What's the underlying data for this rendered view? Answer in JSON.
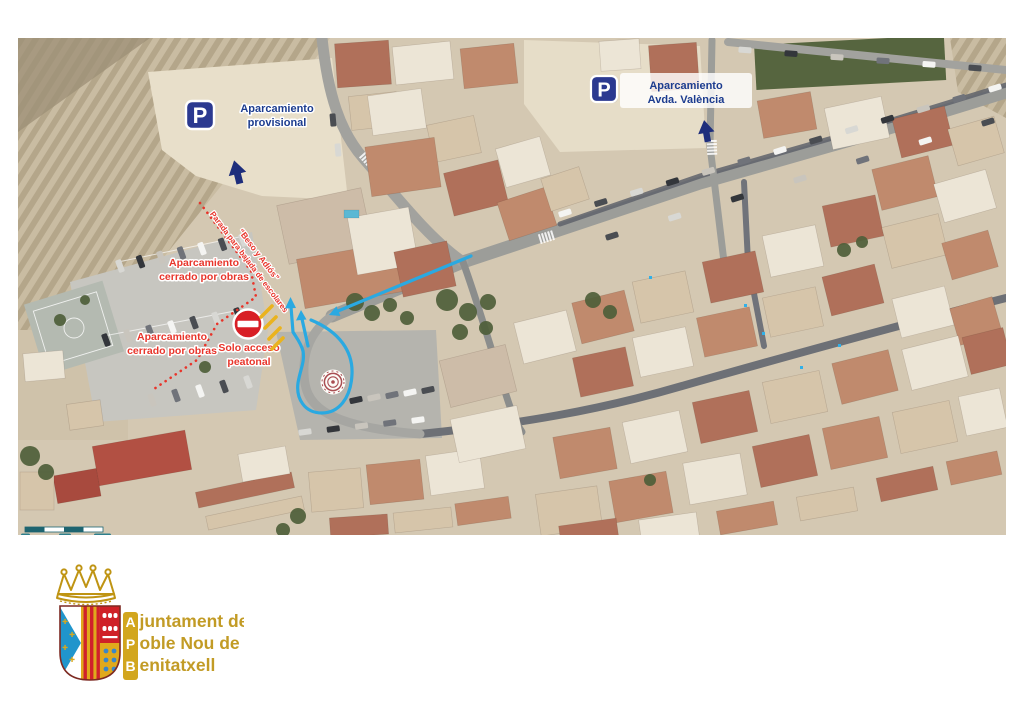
{
  "annotations": {
    "parking_provisional": {
      "icon_letter": "P",
      "line1": "Aparcamiento",
      "line2": "provisional"
    },
    "parking_avda_valencia": {
      "icon_letter": "P",
      "line1": "Aparcamiento",
      "line2": "Avda. València"
    },
    "closed_parking_upper": {
      "line1": "Aparcamiento",
      "line2": "cerrado por obras"
    },
    "closed_parking_lower": {
      "line1": "Aparcamiento",
      "line2": "cerrado por obras"
    },
    "pedestrian_only": {
      "line1": "Solo acceso",
      "line2": "peatonal"
    },
    "kiss_and_ride": {
      "line1": "“Beso y Adiós”",
      "line2": "Parada para bajada de escolares"
    }
  },
  "scale_bar": {
    "label_0": "0",
    "label_mid": "10",
    "label_end": "20m"
  },
  "logo": {
    "initials": [
      "A",
      "P",
      "B"
    ],
    "line1_rest": "juntament del",
    "line2_rest": "oble Nou de",
    "line3_rest": "enitatxell"
  },
  "colors": {
    "navy": "#1c3c8f",
    "p_sign_blue": "#2b3990",
    "signal_red": "#e23327",
    "route_blue": "#2aa9e1",
    "warning_yellow": "#e9b320",
    "gold": "#c39a22",
    "scale_teal": "#1d6470"
  }
}
